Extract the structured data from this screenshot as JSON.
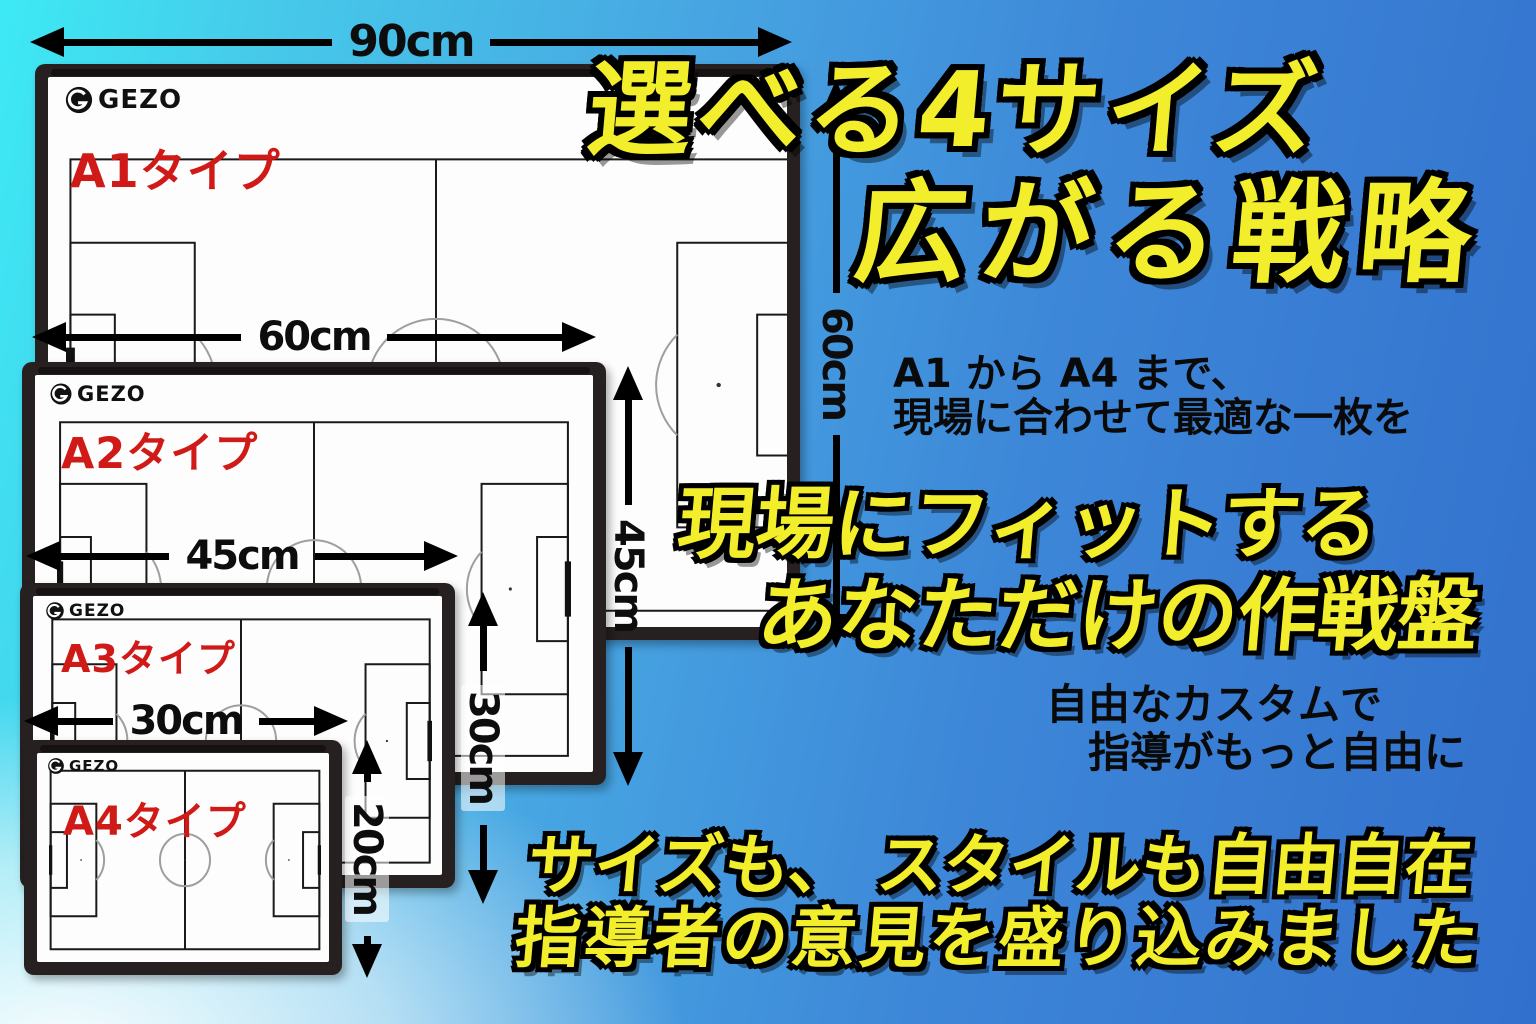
{
  "headline1": {
    "line1": "選べる4サイズ",
    "line2": "広がる戦略"
  },
  "subtext1": {
    "line1": "A1 から A4 まで、",
    "line2": "現場に合わせて最適な一枚を"
  },
  "headline2": {
    "line1": "現場にフィットする",
    "line2": "あなただけの作戦盤"
  },
  "subtext2": {
    "line1": "自由なカスタムで",
    "line2": "指導がもっと自由に"
  },
  "headline3": {
    "line1": "サイズも、 スタイルも自由自在",
    "line2": "指導者の意見を盛り込みました"
  },
  "boards": [
    {
      "brand": "GEZO",
      "label": "A1タイプ",
      "width_label": "90cm",
      "height_label": "60cm"
    },
    {
      "brand": "GEZO",
      "label": "A2タイプ",
      "width_label": "60cm",
      "height_label": "45cm"
    },
    {
      "brand": "GEZO",
      "label": "A3タイプ",
      "width_label": "45cm",
      "height_label": "30cm"
    },
    {
      "brand": "GEZO",
      "label": "A4タイプ",
      "width_label": "30cm",
      "height_label": "20cm"
    }
  ],
  "colors": {
    "headline_yellow": "#f2ee2b",
    "label_red": "#d01a17",
    "frame_dark": "#262020",
    "bg_cyan": "#3deaf4",
    "bg_blue": "#3270cd"
  }
}
